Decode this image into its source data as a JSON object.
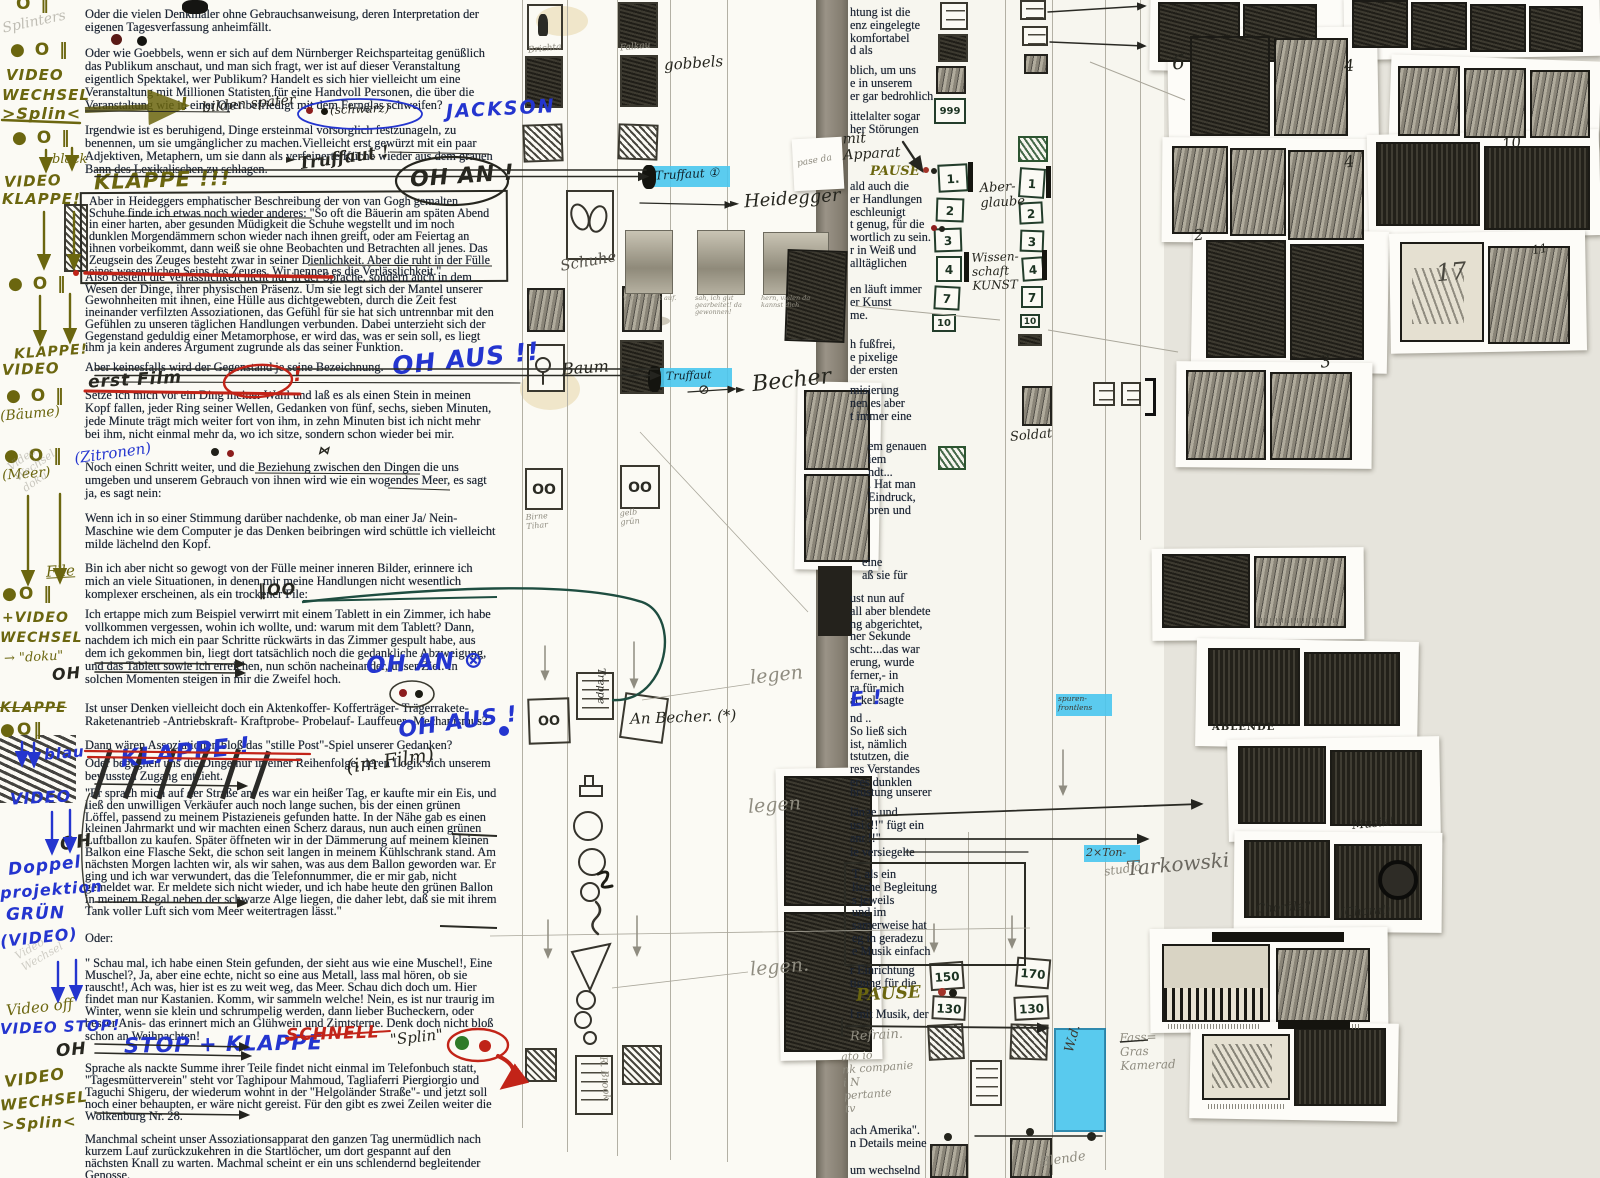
{
  "page": {
    "label": "Filmskript-Arbeitsseite mit Storyboard und Regie-Anmerkungen"
  },
  "colors": {
    "highlight_cyan": "#49c6ee",
    "ink_blue": "#2435cf",
    "ink_olive": "#6b660f",
    "ink_red": "#c22418",
    "typed_ink": "#1b2433",
    "paper": "#fbfaf4"
  },
  "margin": [
    "O ‖",
    "Splinters",
    "● O ‖",
    "VIDEO",
    "WECHSEL",
    ">Splin<",
    "● O ‖",
    "black",
    "VIDEO",
    "KLAPPE!",
    "● O ‖",
    "KLAPPE!",
    "VIDEO",
    "● O ‖",
    "(Bäume)",
    "● O ‖",
    "(Meer)",
    "File",
    "●O ‖",
    "+VIDEO",
    "WECHSEL",
    "→ \"doku\"",
    "OH",
    "KLAPPE",
    "●O‖",
    "blau",
    "VIDEO",
    "OH",
    "Doppel",
    "projektion",
    "GRÜN",
    "(VIDEO)",
    "Video off",
    "VIDEO STOP!",
    "OH",
    "VIDEO",
    "WECHSEL",
    ">Splin<"
  ],
  "paragraphs": [
    "Oder die vielen Denkmäler ohne Gebrauchsanweisung, deren Interpretation der eigenen Tagesverfassung anheimfällt.",
    "Oder wie Goebbels, wenn er sich auf dem Nürnberger Reichsparteitag genüßlich das Publikum anschaut, und man sich fragt, wer ist auf dieser Veranstaltung eigentlich Spektakel, wer Publikum? Handelt es sich hier vielleicht um eine Veranstaltung mit Millionen Statisten für eine Handvoll Personen, die über die Veranstaltung wie in einer Oper  befriedigt mit dem Fernglas schweifen?",
    "Irgendwie ist es beruhigend, Dinge ersteinmal vorsorglich festzunageln, zu benennen, um sie umgänglicher zu machen.Vielleicht erst gewürzt mit ein paar Adjektiven, Metaphern, um sie dann als verfeinerte Küche wieder aus dem grauen Bann des Lexikalischen zu schlagen.",
    "Aber in Heideggers emphatischer Beschreibung der von van Gogh gemalten Schuhe finde ich  etwas noch wieder anderes: \"So oft die Bäuerin am späten Abend in einer harten, aber gesunden Müdigkeit die Schuhe wegstellt und im noch dunklen Morgendämmern schon wieder nach ihnen greift, oder am Feiertag an ihnen vorbeikommt, dann weiß sie ohne Beobachten und Betrachten all jenes. Das Zeugsein des Zeuges besteht zwar in seiner Dienlichkeit. Aber die ruht in der Fülle eines wesentlichen Seins des Zeuges. Wir nennen es die Verlässlichkeit.\"",
    "Also besteht die Verlässlichkeit nicht nur in der Sprache, sondern auch in dem Wesen der Dinge, ihrer physischen Präsenz. Um sie legt sich der Mantel unserer Gewohnheiten mit ihnen, eine Hülle aus dichtgewebten, durch die Zeit fest ineinander verfilzten Assoziationen, das Gefühl für sie hat sich untrennbar mit den Gefühlen zu unseren täglichen Handlungen verbunden. Dabei unterzieht sich der Gegenstand geduldig einer Metamorphose, er wird das, was er sein soll, es liegt ihm ja kein anderes Argument  zugrunde als das seiner Funktion.",
    "Aber keinesfalls wird der Gegenstand je seine Bezeichnung.",
    "Setze ich mich vor ein Ding meiner Wahl und laß es als einen Stein in meinen Kopf fallen, jeder Ring seiner Wellen, Gedanken von fünf, sechs, sieben Minuten, jede Minute trägt mich weiter fort von ihm, in zehn Minuten bist ich nicht mehr bei ihm, nicht einmal mehr da, wo ich sitze, sondern schon wieder bei mir.",
    "Noch einen Schritt weiter, und die Beziehung zwischen den Dingen die uns umgeben und unserem Gebrauch von ihnen wird  wie ein wogendes Meer, es sagt ja, es sagt nein:",
    "Wenn ich in so einer Stimmung darüber nachdenke, ob man einer Ja/ Nein-Maschine wie dem Computer je das Denken beibringen wird  schüttle ich vielleicht milde lächelnd den Kopf.",
    "Bin ich aber nicht so gewogt von der Fülle meiner inneren Bilder, erinnere ich mich an viele Situationen, in denen mir meine Handlungen nicht  wesentlich komplexer erscheinen, als ein trockener File:",
    "Ich ertappe mich zum Beispiel verwirrt mit einem Tablett in ein Zimmer, ich habe vollkommen vergessen, wohin ich wollte, und: warum mit dem Tablett? Dann, nachdem ich mich ein paar Schritte rückwärts in das  Zimmer gespult habe, aus dem ich gekommen bin, liegt dort tatsächlich noch die gedankliche Abzweigung, und das Tablett sowie ich erreichen, nun schön nacheinander, unser Ziel. In solchen Momenten steigen in mir die Zweifel hoch.",
    "Ist unser Denken vielleicht doch ein Aktenkoffer- Kofferträger- Trägerrakete- Raketenantrieb -Antriebskraft- Kraftprobe- Probelauf- Lauffeuer- Mechanismus?",
    "Dann wären Assoziationen bloß das \"stille Post\"-Spiel unserer Gedanken?",
    "Oder begegnen uns die Dinge nur in einer Reihenfolge, deren Logik sich unserem bewussten Zugang entzieht.",
    "\"Er sprach mich auf der Straße an, es war ein heißer Tag, er kaufte mir ein Eis, und ließ den unwilligen Verkäufer auch noch lange suchen, bis der einen grünen Löffel, passend zu meinem Pistazieneis gefunden hatte. In der Nähe gab es einen kleinen Jahrmarkt und wir machten einen Scherz daraus, nun auch einen grünen Luftballon zu kaufen. Später öffneten wir in der Dämmerung auf meinem kleinen Balkon eine Flasche Sekt, die schon seit langen in meinem Kühlschrank stand. Am nächsten Morgen lachten wir, als wir sahen, was aus dem Ballon geworden war. Er ging und ich war verwundert, das die Telefonnummer, die er mir gab, nicht gemeldet war. Er meldete sich nicht wieder, und  ich habe heute den grünen Ballon in meinem Regal neben der schwarze Alge liegen, die daher lebt, daß sie mit ihrem Tank voller Luft sich vom Meer weitertragen lässt.\"",
    "Oder:",
    "\" Schau mal, ich habe einen Stein gefunden, der sieht aus wie eine Muschel!, Eine Muschel?, Ja, aber eine echte, nicht so eine aus Metall, lass mal hören, ob sie rauscht!, Ach was, hier ist es zu weit weg, das Meer. Schau dich doch um. Hier findet man nur Kastanien. Komm, wir sammeln welche! Nein, es ist nur traurig im Winter, wenn sie klein und schrumpelig werden, dann lieber Bucheckern, oder besser Anis- das erinnert mich an Glühwein und Zimtsterne. Denk doch nicht bloß schon an Weihnachten!",
    "Sprache als nackte Summe ihrer Teile findet nicht einmal im Telefonbuch statt, \"Tagesmütterverein\" steht vor Taghipour Mahmoud, Tagliaferri Piergiorgio und Taguchi Shigeru, der wiederum wohnt in der \"Helgoländer Straße\"- und jetzt soll noch einer behaupten, er wäre nicht gereist. Für den gibt es zwei Zeilen weiter die Wolkenburg Nr. 28.",
    "Manchmal scheint unser Assoziationsapparat den ganzen Tag unermüdlich nach kurzem Lauf zurückzukehren in die Startlöcher, um dort gespannt auf den nächsten Knall zu warten. Machmal scheint er ein uns schlendernd begleitender Genosse."
  ],
  "ann": {
    "jackson": "JACKSON",
    "bilden": "bilden später",
    "schwarz": "(schwarz)",
    "truffaut": "Truffaut !",
    "ohan": "OH AN !",
    "klappe3": "KLAPPE !!!",
    "ohaus": "OH AUS !!",
    "erstfilm": "erst Film",
    "zitronen": "(Zitronen)",
    "file_glyph": "‖OO",
    "ohan2": "OH AN ⊗",
    "klappe": "KLAPPE !",
    "ohaus2": "OH AUS !",
    "imfilm": "(im Film)",
    "stop": "STOP + KLAPPE",
    "schnell": "SCHNELL",
    "splin": "\"Splin\"",
    "excl": "!"
  },
  "mid": {
    "brichta": "Brichta",
    "falkau": "Falkau",
    "gobbels": "gobbels",
    "schuhe": "Schuhe",
    "baum": "Baum",
    "birne": "Birne\nTihar",
    "gelb": "gelb\ngrün",
    "truffaut1": "Truffaut ①",
    "truffaut2": "Truffaut",
    "heidegger": "Heidegger",
    "becher": "Becher",
    "anbecher": "An Becher. (*)",
    "treppe": "Treppe",
    "rbrook": "R. Brook",
    "legen": "legen",
    "legen_p": "legen.",
    "photo_caps": [
      "wo für grün auf.",
      "sah, ich gut gearbeitet! da gewonnen!",
      "hern, vielen da kannst dich"
    ],
    "ghost1": "Video\nWechsel\ndoku",
    "ghost2": "Video\nWechsel"
  },
  "rtext": {
    "blocks": [
      "htung ist die\nenz eingelegte\nkomfortabel\nd als",
      "blich, um uns\ne in unserem\ner gar bedrohlich",
      "ittelalter sogar\nher Störungen",
      "ald auch die\ner Handlungen\neschleunigt\nt genug, für die\nwortlich zu sein.\nr in Weiß und\nalltäglichen",
      "en läuft immer\ner Kunst\nme.",
      "h fußfrei,\ne pixelige\nder ersten",
      "misierung\nnen es aber\nt immer eine",
      "em genauen\niem\nndt...\n. Hat man\nEindruck,\noren und",
      "eine\naß sie für",
      "ust nun auf\nall aber blendete\nng abgerichtet,\nner Sekunde\nscht:...das war\nerung, wurde\nferner,- in\nra für mich\nackel sagte",
      "nd ..\nSo ließ sich\nist, nämlich\ntstutzen, die\nres Verstandes\neres dunklen",
      "hrüstung unserer",
      "länge und\nusik!!\" fügt ein\nann!!\"",
      "ie versiegelte",
      "T, als ein\nlische Begleitung\ns jeweils\nund im\nsamerweise hat\neg in geradezu\ne Musik einfach",
      "r Einrichtung\ntigung für die",
      "l mit Musik, der",
      "ach Amerika\".\nn Details meine",
      "um wechselnd"
    ]
  },
  "rann": {
    "mitapparat": "mit\nApparat",
    "pause": "PAUSE",
    "e": "E !",
    "refrain": "Refrain.",
    "notes": "ato io\nnk companie\ni N\npertante\ntv",
    "pase": "pase da"
  },
  "rtrack": {
    "aberglaube": "Aber-\nglaube",
    "wissenschaft": "Wissen-\nschaft\nKUNST",
    "soldat": "Soldat",
    "blende": "Blende",
    "n999": "999",
    "numsA": [
      "1.",
      "2",
      "3",
      "4",
      "7",
      "10"
    ],
    "numsB": [
      "1",
      "2",
      "3",
      "4",
      "7",
      "10"
    ],
    "b150": "150",
    "b130": "130",
    "b170": "170",
    "wd": "W.d.",
    "cyan_note": "spuren-\nfrontlens",
    "ton": "2×Ton-",
    "studio": "studio",
    "tarkowski": "Tarkowski",
    "fass": "Fass=\nGras\nKamerad"
  },
  "thumbs": {
    "n2": "2",
    "n3": "3",
    "n4": "4",
    "n6": "6",
    "n10": "10",
    "n11": "11",
    "n17": "17",
    "ablende": "ABLENDE",
    "musik": "Musik!",
    "chorale": "Choräle?",
    "choral": "(Choral)"
  },
  "glyphs": {
    "tri": "►",
    "oslash": "⊘",
    "bowtie": "⋈"
  }
}
